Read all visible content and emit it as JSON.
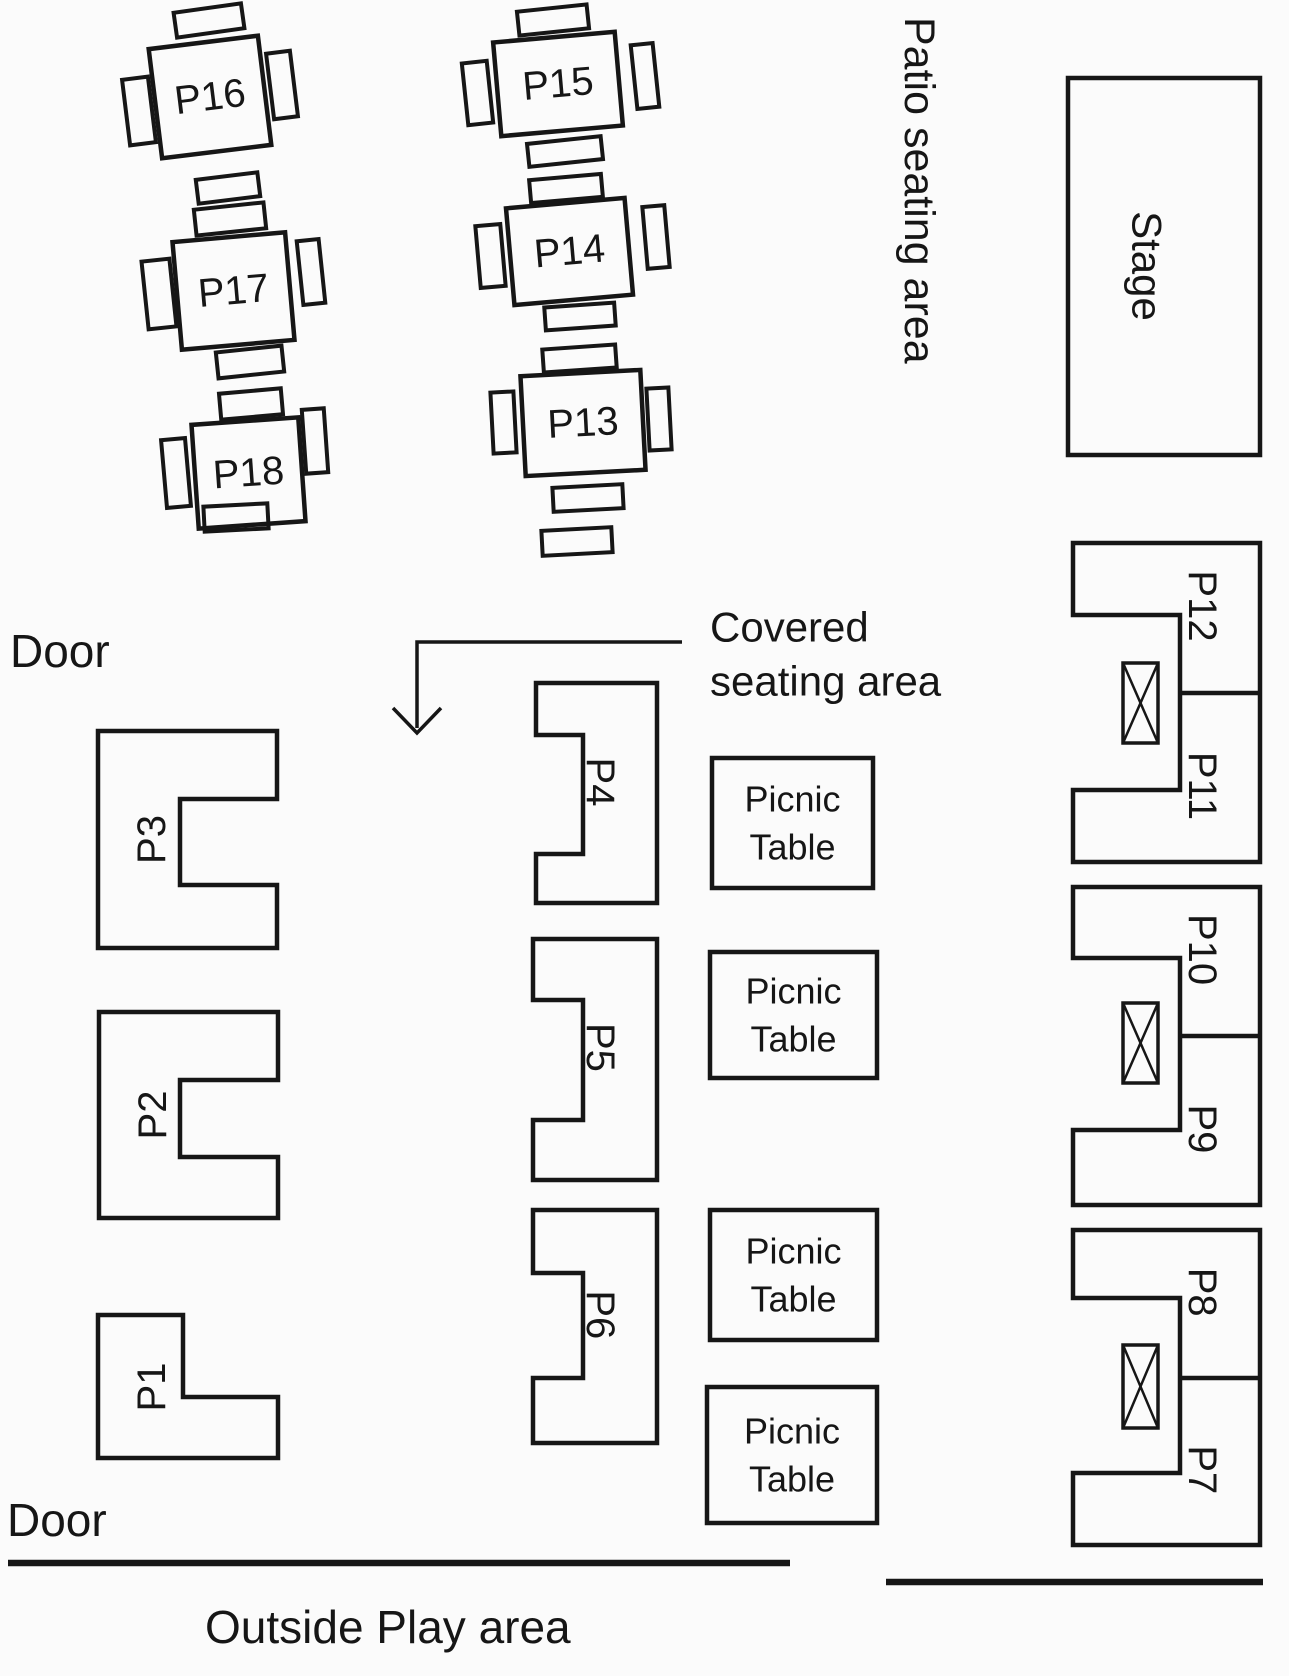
{
  "page": {
    "width": 1289,
    "height": 1676,
    "bg": "#fbfbfb",
    "ink": "#161616"
  },
  "areas": {
    "patio_label": "Patio seating area",
    "stage_label": "Stage",
    "covered_label_line1": "Covered",
    "covered_label_line2": "seating area",
    "outside_label": "Outside Play area",
    "door_top_label": "Door",
    "door_bottom_label": "Door",
    "picnic_label_line1": "Picnic",
    "picnic_label_line2": "Table"
  },
  "stage": {
    "x": 1068,
    "y": 78,
    "w": 192,
    "h": 377
  },
  "square_tables": [
    {
      "label": "P16",
      "x": 155,
      "y": 42,
      "w": 110,
      "h": 110,
      "rot": -7
    },
    {
      "label": "P17",
      "x": 177,
      "y": 237,
      "w": 113,
      "h": 108,
      "rot": -5
    },
    {
      "label": "P18",
      "x": 195,
      "y": 421,
      "w": 107,
      "h": 104,
      "rot": -4
    },
    {
      "label": "P15",
      "x": 497,
      "y": 37,
      "w": 122,
      "h": 94,
      "rot": -5
    },
    {
      "label": "P14",
      "x": 510,
      "y": 203,
      "w": 119,
      "h": 97,
      "rot": -5
    },
    {
      "label": "P13",
      "x": 523,
      "y": 373,
      "w": 120,
      "h": 100,
      "rot": -3
    }
  ],
  "chairs": [
    {
      "x": 175,
      "y": 8,
      "w": 68,
      "h": 25,
      "rot": -8
    },
    {
      "x": 126,
      "y": 78,
      "w": 26,
      "h": 66,
      "rot": -7
    },
    {
      "x": 270,
      "y": 52,
      "w": 24,
      "h": 66,
      "rot": -7
    },
    {
      "x": 197,
      "y": 176,
      "w": 62,
      "h": 24,
      "rot": -7
    },
    {
      "x": 195,
      "y": 206,
      "w": 70,
      "h": 26,
      "rot": -6
    },
    {
      "x": 145,
      "y": 260,
      "w": 28,
      "h": 68,
      "rot": -6
    },
    {
      "x": 300,
      "y": 240,
      "w": 22,
      "h": 64,
      "rot": -6
    },
    {
      "x": 217,
      "y": 349,
      "w": 66,
      "h": 26,
      "rot": -6
    },
    {
      "x": 220,
      "y": 391,
      "w": 62,
      "h": 26,
      "rot": -5
    },
    {
      "x": 164,
      "y": 439,
      "w": 24,
      "h": 68,
      "rot": -5
    },
    {
      "x": 304,
      "y": 409,
      "w": 22,
      "h": 64,
      "rot": -4
    },
    {
      "x": 204,
      "y": 505,
      "w": 64,
      "h": 25,
      "rot": -3
    },
    {
      "x": 518,
      "y": 8,
      "w": 70,
      "h": 24,
      "rot": -6
    },
    {
      "x": 465,
      "y": 62,
      "w": 25,
      "h": 62,
      "rot": -6
    },
    {
      "x": 634,
      "y": 44,
      "w": 22,
      "h": 64,
      "rot": -6
    },
    {
      "x": 528,
      "y": 140,
      "w": 74,
      "h": 23,
      "rot": -6
    },
    {
      "x": 530,
      "y": 177,
      "w": 72,
      "h": 23,
      "rot": -5
    },
    {
      "x": 478,
      "y": 225,
      "w": 25,
      "h": 62,
      "rot": -5
    },
    {
      "x": 645,
      "y": 206,
      "w": 22,
      "h": 62,
      "rot": -5
    },
    {
      "x": 545,
      "y": 305,
      "w": 70,
      "h": 23,
      "rot": -4
    },
    {
      "x": 543,
      "y": 347,
      "w": 73,
      "h": 23,
      "rot": -4
    },
    {
      "x": 492,
      "y": 392,
      "w": 23,
      "h": 61,
      "rot": -3
    },
    {
      "x": 648,
      "y": 388,
      "w": 22,
      "h": 62,
      "rot": -3
    },
    {
      "x": 553,
      "y": 486,
      "w": 70,
      "h": 24,
      "rot": -3
    },
    {
      "x": 542,
      "y": 529,
      "w": 70,
      "h": 25,
      "rot": -3
    }
  ],
  "booths_right_open": [
    {
      "label": "P3",
      "x": 98,
      "y": 731,
      "w": 179,
      "h": 217,
      "arm_top": 68,
      "arm_bottom": 63,
      "notch": 97
    },
    {
      "label": "P2",
      "x": 99,
      "y": 1012,
      "w": 179,
      "h": 206,
      "arm_top": 68,
      "arm_bottom": 61,
      "notch": 98
    }
  ],
  "booth_l_shape": {
    "label": "P1",
    "points": [
      [
        98,
        1315
      ],
      [
        183,
        1315
      ],
      [
        183,
        1397
      ],
      [
        278,
        1397
      ],
      [
        278,
        1458
      ],
      [
        98,
        1458
      ]
    ],
    "label_cx": 152,
    "label_cy": 1387
  },
  "booths_left_open": [
    {
      "label": "P4",
      "x": 536,
      "y": 683,
      "w": 121,
      "h": 220,
      "arm_top": 52,
      "arm_bottom": 49,
      "notch": 47
    },
    {
      "label": "P5",
      "x": 533,
      "y": 939,
      "w": 124,
      "h": 241,
      "arm_top": 61,
      "arm_bottom": 60,
      "notch": 50
    },
    {
      "label": "P6",
      "x": 533,
      "y": 1210,
      "w": 124,
      "h": 233,
      "arm_top": 63,
      "arm_bottom": 65,
      "notch": 50
    }
  ],
  "booth_pairs": [
    {
      "label_top": "P12",
      "label_bottom": "P11",
      "x": 1073,
      "y": 543,
      "w": 187,
      "h": 319,
      "arm_top": 72,
      "arm_bottom": 72,
      "notch": 107,
      "divider": 150,
      "xtable": {
        "x": 1123,
        "y": 663,
        "w": 35,
        "h": 80
      }
    },
    {
      "label_top": "P10",
      "label_bottom": "P9",
      "x": 1073,
      "y": 887,
      "w": 187,
      "h": 318,
      "arm_top": 71,
      "arm_bottom": 75,
      "notch": 107,
      "divider": 149,
      "xtable": {
        "x": 1123,
        "y": 1003,
        "w": 35,
        "h": 80
      }
    },
    {
      "label_top": "P8",
      "label_bottom": "P7",
      "x": 1073,
      "y": 1230,
      "w": 187,
      "h": 315,
      "arm_top": 68,
      "arm_bottom": 72,
      "notch": 107,
      "divider": 148,
      "xtable": {
        "x": 1123,
        "y": 1345,
        "w": 35,
        "h": 83
      }
    }
  ],
  "picnic_tables": [
    {
      "x": 712,
      "y": 758,
      "w": 161,
      "h": 130
    },
    {
      "x": 710,
      "y": 952,
      "w": 167,
      "h": 126
    },
    {
      "x": 710,
      "y": 1210,
      "w": 167,
      "h": 130
    },
    {
      "x": 707,
      "y": 1387,
      "w": 170,
      "h": 136
    }
  ],
  "boundary_lines": [
    {
      "x1": 8,
      "y1": 1563,
      "x2": 790,
      "y2": 1563
    },
    {
      "x1": 886,
      "y1": 1582,
      "x2": 1263,
      "y2": 1582
    }
  ],
  "arrow": {
    "x1": 682,
    "y1": 642,
    "x2": 417,
    "y2": 642,
    "x3": 417,
    "y3": 728,
    "tip_x": 417,
    "tip_y": 733,
    "wing": 24,
    "wing_up": 25
  },
  "text_positions": {
    "patio": {
      "x": 919,
      "y": 17,
      "rot": 90,
      "size": 43,
      "anchor": "start"
    },
    "stage": {
      "x": 1147,
      "y": 266,
      "rot": 90,
      "size": 42,
      "anchor": "middle"
    },
    "door_top": {
      "x": 10,
      "y": 651,
      "size": 46
    },
    "door_bottom": {
      "x": 7,
      "y": 1520,
      "size": 46
    },
    "covered1": {
      "x": 710,
      "y": 627,
      "size": 42
    },
    "covered2": {
      "x": 710,
      "y": 681,
      "size": 42
    },
    "outside": {
      "x": 205,
      "y": 1627,
      "size": 46
    }
  },
  "style": {
    "booth_stroke": 4.5,
    "table_stroke": 4.5,
    "chair_stroke": 4,
    "line_stroke": 6.5,
    "arrow_stroke": 3.5,
    "table_font": 40,
    "booth_font": 40,
    "picnic_font": 36
  }
}
